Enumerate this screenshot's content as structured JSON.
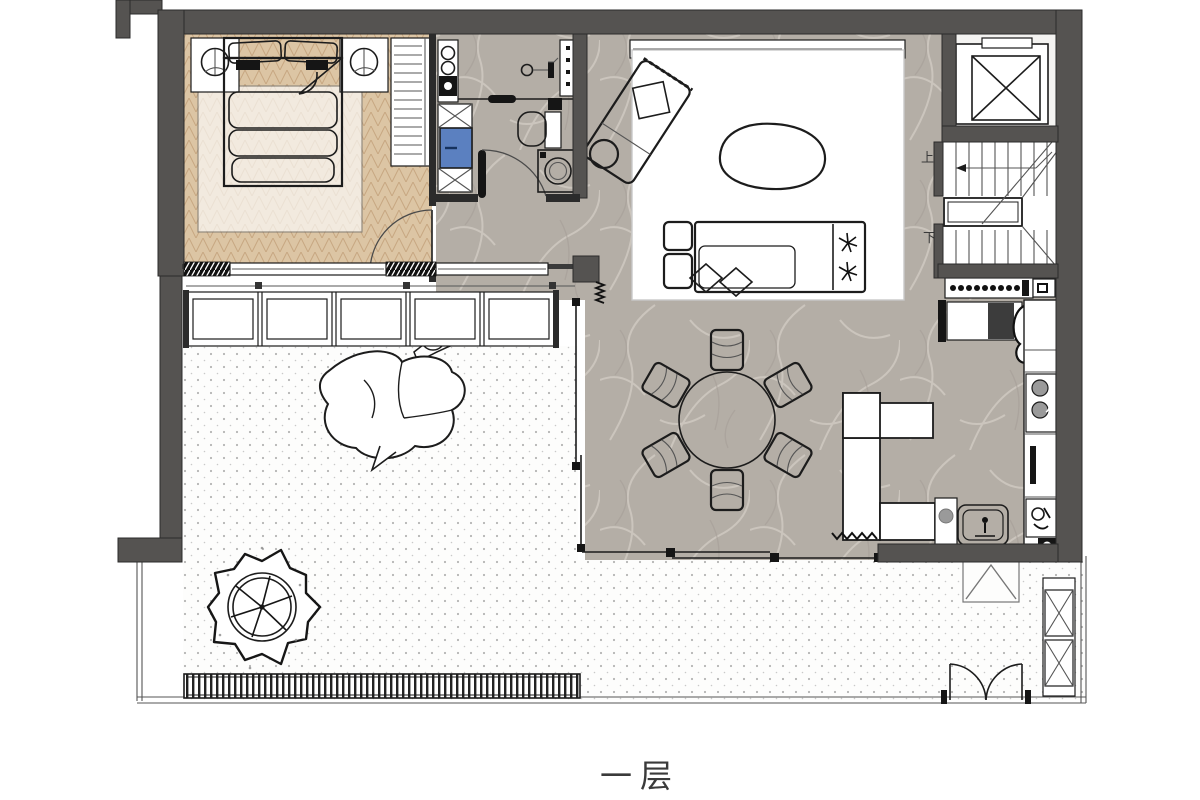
{
  "title": {
    "floor_label": "一层"
  },
  "stairs": {
    "up_label": "上",
    "down_label": "下"
  },
  "colors": {
    "wall": "#555351",
    "wall_dark": "#2b2b2b",
    "line": "#1c1c1c",
    "wood": "#dcc5a4",
    "wood_line": "#c5a47e",
    "stone": "#b4aea6",
    "stone_vein": "#d2ccc4",
    "terrace_bg": "#fdfdfc",
    "terrace_dot": "#b4b4b4",
    "accent_blue": "#5b80c0",
    "label": "#3a3a3a"
  }
}
